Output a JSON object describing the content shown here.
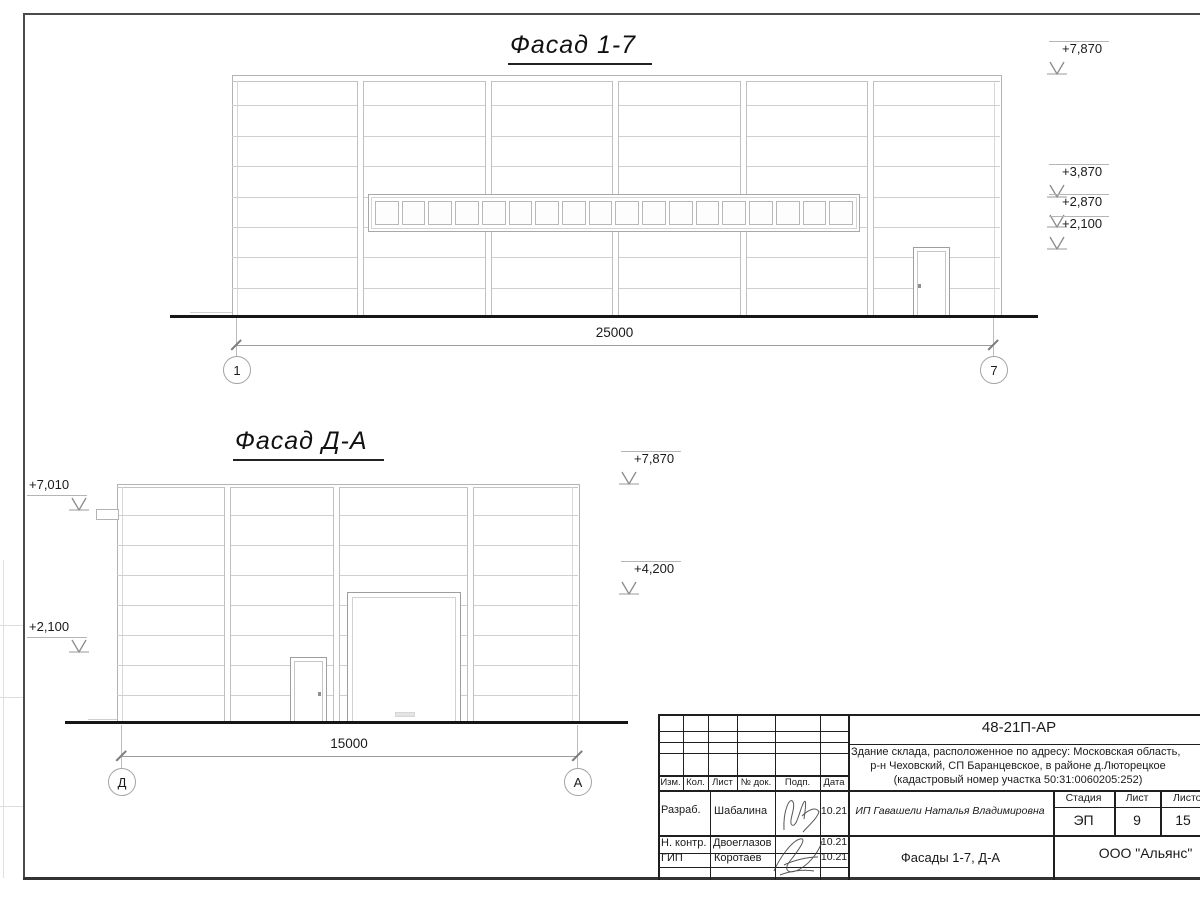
{
  "facade17": {
    "title": "Фасад 1-7",
    "dimension": "25000",
    "axis_left": "1",
    "axis_right": "7",
    "levels": [
      "+7,870",
      "+3,870",
      "+2,870",
      "+2,100"
    ]
  },
  "facadeDA": {
    "title": "Фасад Д-А",
    "dimension": "15000",
    "axis_left": "Д",
    "axis_right": "А",
    "levels_left": [
      "+7,010",
      "+2,100"
    ],
    "levels_right": [
      "+7,870",
      "+4,200"
    ]
  },
  "titleblock": {
    "code": "48-21П-АР",
    "address_line1": "Здание склада, расположенное по адресу: Московская область,",
    "address_line2": "р-н Чеховский, СП Баранцевское, в районе д.Люторецкое",
    "address_line3": "(кадастровый номер участка 50:31:0060205:252)",
    "rev_headers": [
      "Изм.",
      "Кол.",
      "Лист",
      "№ док.",
      "Подп.",
      "Дата"
    ],
    "roles": [
      {
        "role": "Разраб.",
        "name": "Шабалина",
        "date": "10.21"
      },
      {
        "role": "Н. контр.",
        "name": "Двоеглазов",
        "date": "10.21"
      },
      {
        "role": "ГИП",
        "name": "Коротаев",
        "date": "10.21"
      }
    ],
    "client": "ИП Гавашели Наталья Владимировна",
    "stage_label": "Стадия",
    "sheet_label": "Лист",
    "sheets_label": "Листов",
    "stage": "ЭП",
    "sheet": "9",
    "sheets": "15",
    "sheet_title": "Фасады 1-7, Д-А",
    "company": "ООО \"Альянс\""
  },
  "colors": {
    "frame": "#4a4a4a",
    "drawing_line": "#b3b3b3",
    "panel_line": "#cfcfcf",
    "ground": "#161616",
    "titleblock_line": "#1f1f1f"
  }
}
